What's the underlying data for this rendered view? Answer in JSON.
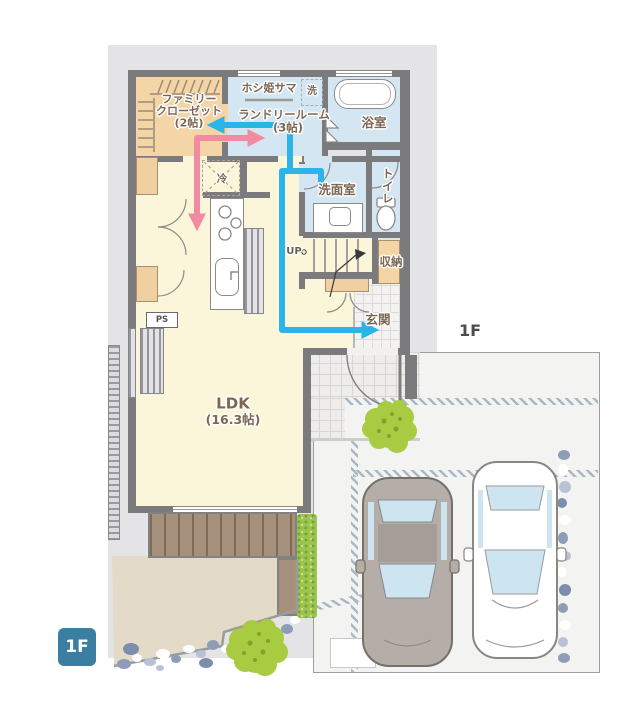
{
  "badge": "1F",
  "floor_area_label": "1F",
  "rooms": {
    "family_closet_line1": "ファミリー",
    "family_closet_line2": "クローゼット",
    "family_closet_size": "(2帖)",
    "hoshihime_sama": "ホシ姫サマ",
    "washing_machine": "洗",
    "laundry_room": "ランドリールーム",
    "laundry_size": "(3帖)",
    "bathroom": "浴室",
    "washroom": "洗面室",
    "toilet": "トイレ",
    "refrigerator": "冷",
    "stairs_up": "UP",
    "storage": "収納",
    "entrance": "玄関",
    "ldk": "LDK",
    "ldk_size": "(16.3帖)",
    "pipe_space": "PS"
  },
  "legend_colors": {
    "wet_flow_line": "#2ab4e8",
    "family_flow_line": "#f28aa2",
    "wet_rooms": "#d3e6f1",
    "storage_rooms": "#f4d6a6",
    "living_floor": "#fbf6da",
    "walls": "#7b7b7e",
    "site_ground": "#e4e4e6",
    "driveway": "#f3f3f1",
    "floor_badge_bg": "#3a7fa1",
    "greenery": "#a8cb41",
    "deck": "#a5907c"
  }
}
